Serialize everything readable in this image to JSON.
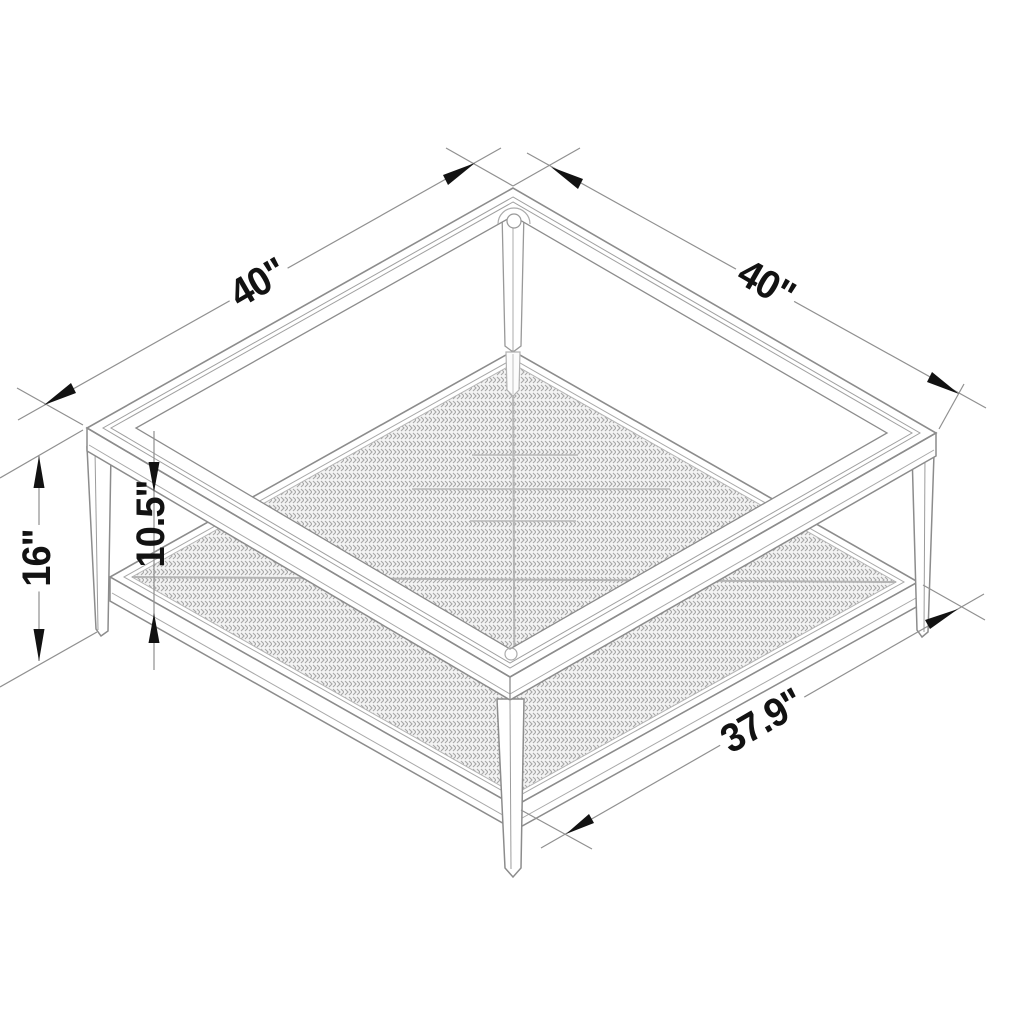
{
  "drawing": {
    "title": "coffee-table-isometric-dimension-drawing",
    "dimensions": {
      "top_left_edge": "40\"",
      "top_right_edge": "40\"",
      "overall_height": "16\"",
      "shelf_clearance": "10.5\"",
      "shelf_width": "37.9\""
    },
    "colors": {
      "background": "#ffffff",
      "line_main": "#8c8c8c",
      "line_light": "#a8a8a8",
      "mesh": "#a6a6a6",
      "annotation": "#121212"
    }
  }
}
